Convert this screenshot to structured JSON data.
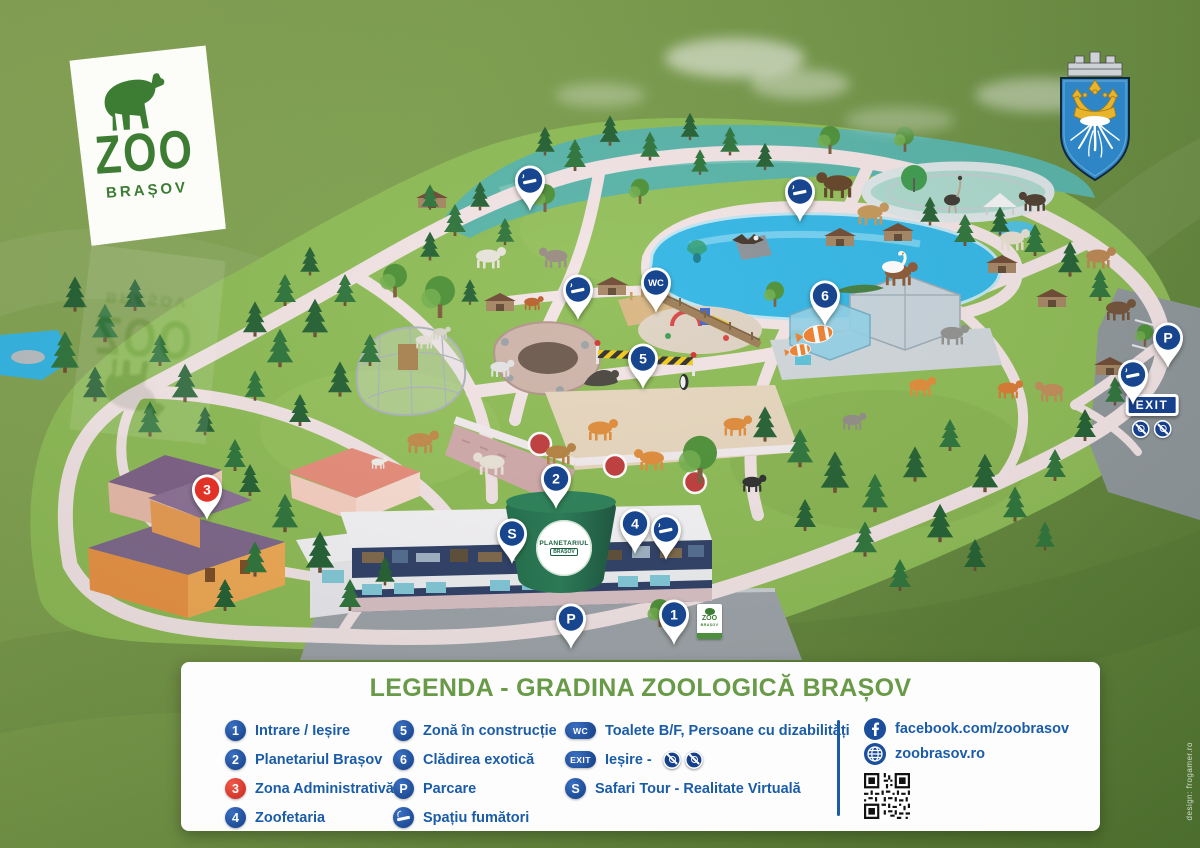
{
  "logo": {
    "name": "ZOO",
    "city": "BRAȘOV"
  },
  "map": {
    "pin_color": "#17468f",
    "pin_red": "#e23227",
    "planetarium": {
      "line1": "PLANETARIUL",
      "line2": "BRAȘOV"
    },
    "entrance_sign": {
      "line1": "ZOO",
      "line2": "BRAȘOV"
    },
    "exit_sign": {
      "label": "EXIT"
    },
    "markers": [
      {
        "name": "pin-smoking-area-1",
        "type": "smoking",
        "x": 530,
        "y": 180
      },
      {
        "name": "pin-smoking-area-2",
        "type": "smoking",
        "x": 800,
        "y": 191
      },
      {
        "name": "pin-smoking-area-3",
        "type": "smoking",
        "x": 578,
        "y": 289
      },
      {
        "name": "pin-wc",
        "type": "label",
        "label": "WC",
        "x": 656,
        "y": 282
      },
      {
        "name": "pin-6-cladirea-exotica",
        "type": "label",
        "label": "6",
        "x": 825,
        "y": 295
      },
      {
        "name": "pin-5-zona-constructie",
        "type": "label",
        "label": "5",
        "x": 643,
        "y": 358
      },
      {
        "name": "pin-parking-north",
        "type": "label",
        "label": "P",
        "x": 1168,
        "y": 337
      },
      {
        "name": "pin-smoking-area-4",
        "type": "smoking",
        "x": 1133,
        "y": 374
      },
      {
        "name": "pin-3-zona-administrativa",
        "type": "label",
        "label": "3",
        "x": 207,
        "y": 489,
        "red": true
      },
      {
        "name": "pin-2-planetariul",
        "type": "label",
        "label": "2",
        "x": 556,
        "y": 478
      },
      {
        "name": "pin-safari-tour",
        "type": "label",
        "label": "S",
        "x": 512,
        "y": 533
      },
      {
        "name": "pin-4-zoofetaria",
        "type": "label",
        "label": "4",
        "x": 635,
        "y": 523
      },
      {
        "name": "pin-smoking-area-5",
        "type": "smoking",
        "x": 666,
        "y": 529
      },
      {
        "name": "pin-parking-south",
        "type": "label",
        "label": "P",
        "x": 571,
        "y": 618
      },
      {
        "name": "pin-1-intrare",
        "type": "label",
        "label": "1",
        "x": 674,
        "y": 614
      }
    ]
  },
  "legend": {
    "title": "LEGENDA - GRADINA ZOOLOGICĂ BRAȘOV",
    "columns": [
      {
        "items": [
          {
            "badge": "1",
            "shape": "circle",
            "label": "Intrare / Ieșire"
          },
          {
            "badge": "2",
            "shape": "circle",
            "label": "Planetariul Brașov"
          },
          {
            "badge": "3",
            "shape": "circle",
            "red": true,
            "label": "Zona Administrativă"
          },
          {
            "badge": "4",
            "shape": "circle",
            "label": "Zoofetaria"
          }
        ]
      },
      {
        "items": [
          {
            "badge": "5",
            "shape": "circle",
            "label": "Zonă în construcție"
          },
          {
            "badge": "6",
            "shape": "circle",
            "label": "Clădirea exotică"
          },
          {
            "badge": "P",
            "shape": "circle",
            "label": "Parcare"
          },
          {
            "badge": "smoking-icon",
            "shape": "smoking",
            "label": "Spațiu fumători"
          }
        ]
      },
      {
        "items": [
          {
            "badge": "WC",
            "shape": "oval",
            "label": "Toalete B/F, Persoane cu dizabilități"
          },
          {
            "badge": "EXIT",
            "shape": "oval",
            "label": "Ieșire -",
            "suffix_icons": [
              "no-wheelchair-icon",
              "no-stroller-icon"
            ]
          },
          {
            "badge": "S",
            "shape": "circle",
            "label": "Safari Tour - Realitate Virtuală"
          }
        ]
      }
    ],
    "links": [
      {
        "icon": "facebook-icon",
        "text": "facebook.com/zoobrasov"
      },
      {
        "icon": "globe-icon",
        "text": "zoobrasov.ro"
      }
    ]
  },
  "credits": "design: frogamer.ro"
}
